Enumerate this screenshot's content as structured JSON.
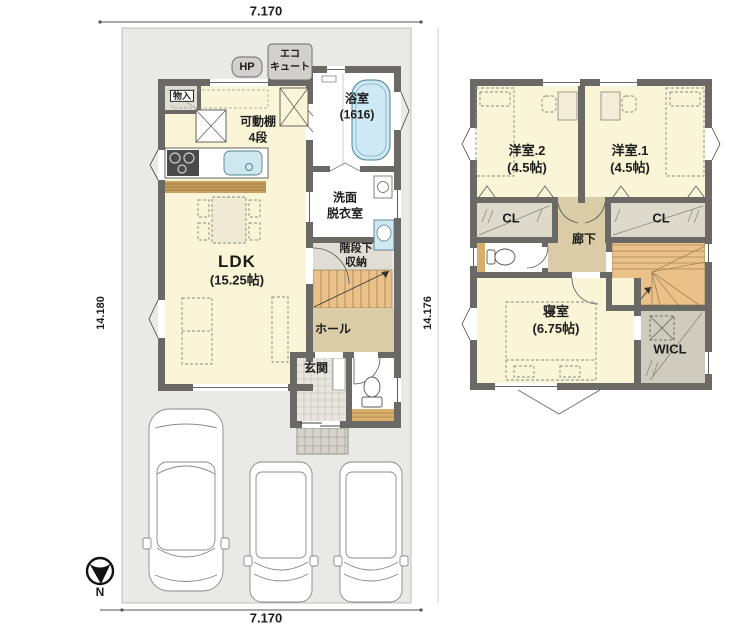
{
  "dimensions": {
    "top": "7.170",
    "bottom": "7.170",
    "left": "14.180",
    "right": "14.176"
  },
  "compass": {
    "north_label": "N"
  },
  "floor1": {
    "labels": {
      "hp": "HP",
      "eco_cute": "エコ\nキュート",
      "storage": "物入",
      "movable_shelf": "可動棚\n4段",
      "bathroom": "浴室\n(1616)",
      "washroom": "洗面\n脱衣室",
      "under_stair_storage": "階段下\n収納",
      "ldk_name": "LDK",
      "ldk_size": "(15.25帖)",
      "hall": "ホール",
      "entrance": "玄関"
    }
  },
  "floor2": {
    "labels": {
      "room2": "洋室.2\n(4.5帖)",
      "room1": "洋室.1\n(4.5帖)",
      "closet_left": "CL",
      "closet_right": "CL",
      "corridor": "廊下",
      "bedroom": "寝室\n(6.75帖)",
      "wicl": "WICL"
    }
  },
  "colors": {
    "room_floor": "#faf5d6",
    "hall_floor": "#d9cca6",
    "stairs": "#e9c189",
    "closet_floor": "#dddacb",
    "wall": "#6b6965",
    "site": "#e9e9e7",
    "tub": "#cfe9f4",
    "wood": "#d8ae6b"
  }
}
